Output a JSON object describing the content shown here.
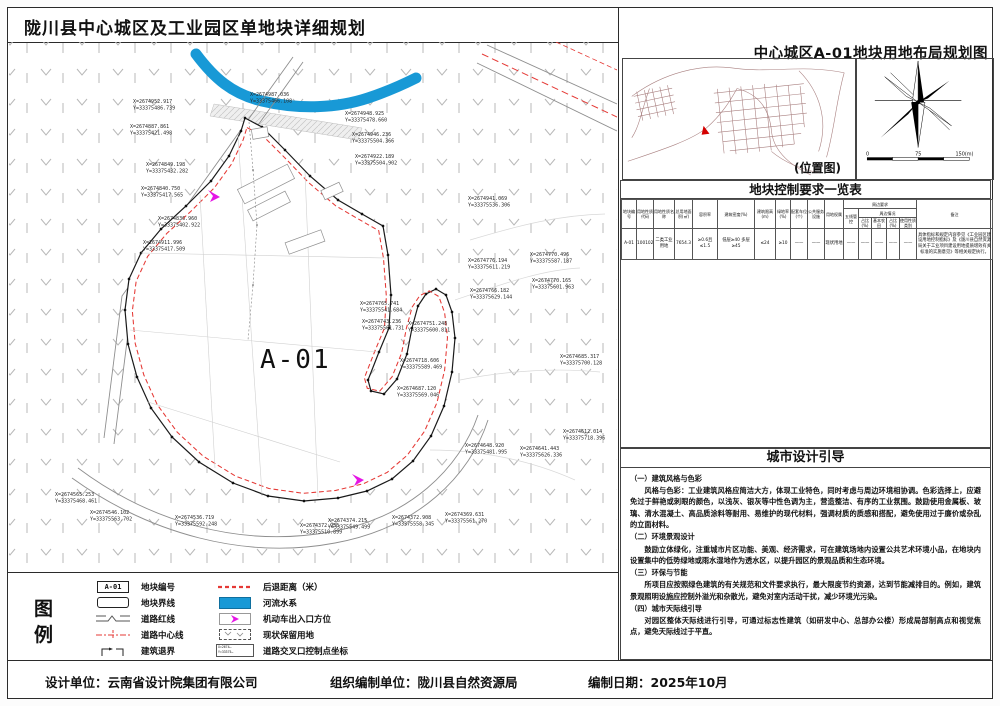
{
  "sheet": {
    "title": "陇川县中心城区及工业园区单地块详细规划",
    "right_title": "中心城区A-01地块用地布局规划图",
    "footer": {
      "design": "设计单位：云南省设计院集团有限公司",
      "org": "组织编制单位：陇川县自然资源局",
      "date": "编制日期：2025年10月"
    }
  },
  "map": {
    "parcel_label": "A-01",
    "coordinate_labels": [
      {
        "x": 133,
        "y": 103,
        "l1": "X=2674952.917",
        "l2": "Y=33375486.739"
      },
      {
        "x": 130,
        "y": 128,
        "l1": "X=2674887.861",
        "l2": "Y=33375421.498"
      },
      {
        "x": 146,
        "y": 166,
        "l1": "X=2674849.198",
        "l2": "Y=33375432.282"
      },
      {
        "x": 141,
        "y": 190,
        "l1": "X=2674840.750",
        "l2": "Y=33375417.565"
      },
      {
        "x": 158,
        "y": 220,
        "l1": "X=2674836.960",
        "l2": "Y=33375402.922"
      },
      {
        "x": 143,
        "y": 244,
        "l1": "X=2674911.996",
        "l2": "Y=33375417.509"
      },
      {
        "x": 250,
        "y": 96,
        "l1": "X=2674987.036",
        "l2": "Y=33375466.108"
      },
      {
        "x": 345,
        "y": 115,
        "l1": "X=2674948.925",
        "l2": "Y=33375478.660"
      },
      {
        "x": 352,
        "y": 136,
        "l1": "X=2674946.236",
        "l2": "Y=33375504.366"
      },
      {
        "x": 355,
        "y": 158,
        "l1": "X=2674922.189",
        "l2": "Y=33375504.902"
      },
      {
        "x": 468,
        "y": 200,
        "l1": "X=2674941.069",
        "l2": "Y=33375536.306"
      },
      {
        "x": 530,
        "y": 256,
        "l1": "X=2674770.496",
        "l2": "Y=33375587.187"
      },
      {
        "x": 468,
        "y": 262,
        "l1": "X=2674776.194",
        "l2": "Y=33375611.219"
      },
      {
        "x": 532,
        "y": 282,
        "l1": "X=2674770.165",
        "l2": "Y=33375601.963"
      },
      {
        "x": 470,
        "y": 292,
        "l1": "X=2674766.182",
        "l2": "Y=33375629.144"
      },
      {
        "x": 360,
        "y": 305,
        "l1": "X=2674765.741",
        "l2": "Y=33375541.684"
      },
      {
        "x": 362,
        "y": 323,
        "l1": "X=2674743.236",
        "l2": "Y=33375561.731"
      },
      {
        "x": 408,
        "y": 325,
        "l1": "X=2674751.248",
        "l2": "Y=33375600.811"
      },
      {
        "x": 400,
        "y": 362,
        "l1": "X=2674718.606",
        "l2": "Y=33375589.469"
      },
      {
        "x": 397,
        "y": 390,
        "l1": "X=2674687.120",
        "l2": "Y=33375569.046"
      },
      {
        "x": 560,
        "y": 358,
        "l1": "X=2674685.317",
        "l2": "Y=33375700.128"
      },
      {
        "x": 563,
        "y": 433,
        "l1": "X=2674612.014",
        "l2": "Y=33375718.396"
      },
      {
        "x": 465,
        "y": 447,
        "l1": "X=2674648.920",
        "l2": "Y=33375481.995"
      },
      {
        "x": 520,
        "y": 450,
        "l1": "X=2674641.443",
        "l2": "Y=33375626.336"
      },
      {
        "x": 445,
        "y": 516,
        "l1": "X=2674369.631",
        "l2": "Y=33375561.270"
      },
      {
        "x": 392,
        "y": 519,
        "l1": "X=2674372.908",
        "l2": "Y=33375558.345"
      },
      {
        "x": 328,
        "y": 522,
        "l1": "X=2674374.215",
        "l2": "Y=33375549.499"
      },
      {
        "x": 300,
        "y": 527,
        "l1": "X=2674372.955",
        "l2": "Y=33375510.899"
      },
      {
        "x": 55,
        "y": 496,
        "l1": "X=2674565.253",
        "l2": "Y=33375468.461"
      },
      {
        "x": 90,
        "y": 514,
        "l1": "X=2674546.102",
        "l2": "Y=33375563.702"
      },
      {
        "x": 175,
        "y": 519,
        "l1": "X=2674536.719",
        "l2": "Y=33375592.248"
      }
    ]
  },
  "location_map": {
    "caption": "(位置图)"
  },
  "scalebar": {
    "left": "0",
    "mid": "75",
    "right": "150(m)"
  },
  "table": {
    "title": "地块控制要求一览表",
    "headers": [
      "地块编号",
      "用地性质代码",
      "用地性质名称",
      "总用地面积(㎡)",
      "容积率",
      "建筑密度(%)",
      "建筑限高(m)",
      "绿地率(%)",
      "配套车位(个)",
      "公共服务设施",
      "用地权属"
    ],
    "group": {
      "top": "周边要求",
      "col1": "五线管控",
      "sub": "周边情况",
      "cols": [
        "占比(%)",
        "基本农田",
        "占比(%)",
        "使用性质类别"
      ]
    },
    "remarks_header": "备注",
    "row": [
      "A-01",
      "100102",
      "二类工业用地",
      "7654.3",
      "≥0.6且≤1.5",
      "低层≥40 多层≥45",
      "≤24",
      "≥10",
      "——",
      "——",
      "现状用地",
      "——",
      "——",
      "——",
      "——",
      "——",
      "具体指标和规定内容参见《工业园区建设用地控制指标》及《陇川县自然资源局关于工业项目建设用地提质增效有关标准的实施意见》等相关规定执行。"
    ]
  },
  "design_guide": {
    "title": "城市设计引导",
    "sections": [
      {
        "head": "（一）建筑风格与色彩",
        "body": "风格与色彩：工业建筑风格应简洁大方，体现工业特色，同时考虑与周边环境相协调。色彩选择上，应避免过于鲜艳或刺眼的颜色，以浅灰、银灰等中性色调为主，营造整洁、有序的工业氛围。鼓励使用金属板、玻璃、清水混凝土、高品质涂料等耐用、易维护的现代材料，强调材质的质感和搭配，避免使用过于廉价或杂乱的立面材料。"
      },
      {
        "head": "（二）环境景观设计",
        "body": "鼓励立体绿化，注重城市片区功能、美观、经济需求，可在建筑场地内设置公共艺术环境小品，在地块内设置集中的低势绿地或雨水湿地作为透水区，以提升园区的景观品质和生态环境。"
      },
      {
        "head": "（三）环保与节能",
        "body": "所项目应按照绿色建筑的有关规范和文件要求执行，最大限度节约资源，达到节能减排目的。例如，建筑景观照明设施应控制外溢光和杂散光，避免对室内活动干扰，减少环境光污染。"
      },
      {
        "head": "（四）城市天际线引导",
        "body": "对园区整体天际线进行引导，可通过标志性建筑（如研发中心、总部办公楼）形成局部制高点和视觉焦点，避免天际线过于平直。"
      }
    ]
  },
  "legend": {
    "title": "图例",
    "parcel_code": "A-01",
    "items_left": [
      "地块编号",
      "地块界线",
      "道路红线",
      "道路中心线",
      "建筑退界"
    ],
    "items_right": [
      "后退距离（米）",
      "河流水系",
      "机动车出入口方位",
      "现状保留用地",
      "道路交叉口控制点坐标"
    ],
    "xy_line1": "X=2674…",
    "xy_line2": "Y=33375…"
  },
  "colors": {
    "river": "#1899d6",
    "setback": "#e53935",
    "entrance": "#e515e5"
  }
}
